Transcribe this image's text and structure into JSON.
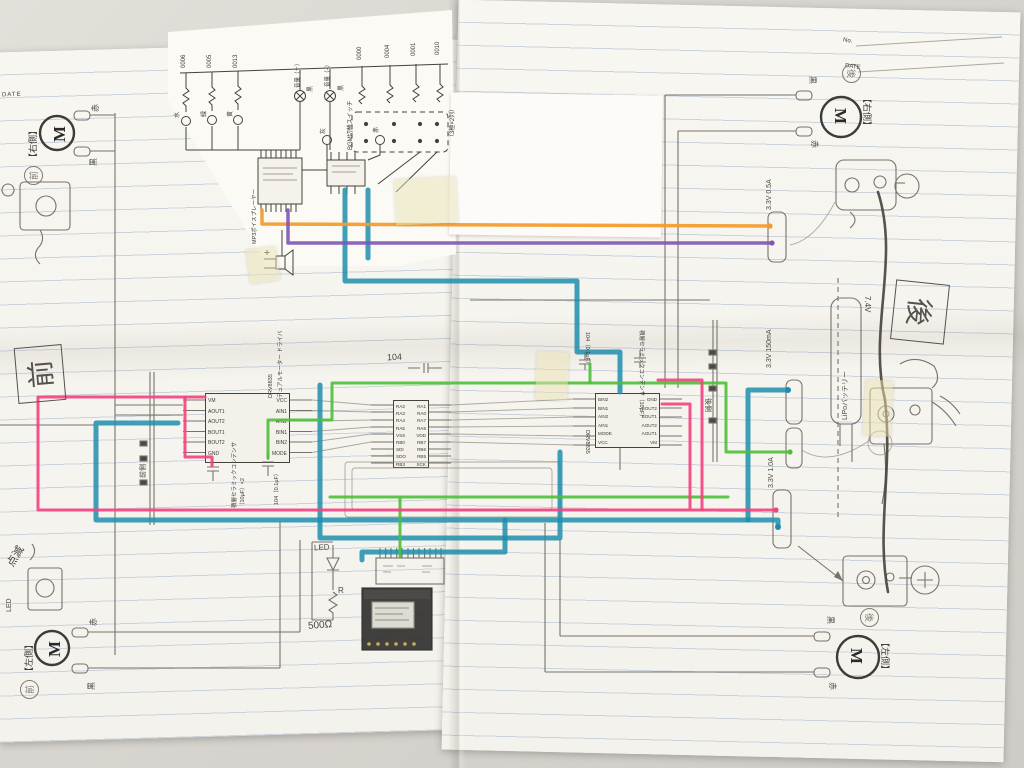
{
  "colors": {
    "wire_pink": "#f2427e",
    "wire_green": "#4fbf3a",
    "wire_teal": "#1d8dad",
    "wire_orange": "#f59a2a",
    "wire_purple": "#7e57b5",
    "pencil": "#6e675e",
    "paper": "#f8f6f0",
    "ruled_line": "#ccd2db",
    "background": "#d8d4cf"
  },
  "left_page": {
    "header_date": "DATE"
  },
  "right_page": {
    "header_no": "No.",
    "header_date": "DATE"
  },
  "overlay": {
    "resistor_ids": [
      "0006",
      "0005",
      "0013"
    ],
    "wire_color_labels": [
      "水",
      "緑",
      "黄"
    ],
    "volume_labels": [
      "音量（＋）",
      "音量（−）"
    ],
    "transistor_labels": [
      "黒",
      "黒",
      "灰",
      "赤"
    ],
    "switch_ids": [
      "0000",
      "0004",
      "0001",
      "0010"
    ],
    "switch_label": "BGM切替スイッチ",
    "switch_note": "（3極×2列）",
    "player_label": "MP3ボイスプレーヤー"
  },
  "motors": {
    "front_right": {
      "m": "M",
      "side": "【右側】",
      "stamp": "前",
      "red": "赤",
      "black": "黒"
    },
    "front_left": {
      "m": "M",
      "side": "【左側】",
      "stamp": "前",
      "red": "赤",
      "black": "黒"
    },
    "rear_right": {
      "m": "M",
      "side": "【右側】",
      "stamp": "後",
      "red": "赤",
      "black": "黒"
    },
    "rear_left": {
      "m": "M",
      "side": "【左側】",
      "stamp": "後",
      "red": "赤",
      "black": "黒"
    }
  },
  "driver_left": {
    "name": "DRV8835",
    "subtitle": "デュアルモーター ドライバ",
    "pins_left": [
      "VM",
      "AOUT1",
      "AOUT2",
      "BOUT1",
      "BOUT2",
      "GND"
    ],
    "pins_right": [
      "VCC",
      "AIN1",
      "AIN2",
      "BIN1",
      "BIN2",
      "MODE"
    ]
  },
  "driver_right": {
    "name": "DRV8835",
    "pins_left": [
      "BIN2",
      "BIN1",
      "AIN2",
      "AIN1",
      "MODE",
      "VCC"
    ],
    "pins_right": [
      "GND",
      "BOUT2",
      "BOUT1",
      "AOUT2",
      "AOUT1",
      "VM"
    ]
  },
  "mcu": {
    "pins_left": [
      "RA2",
      "RA3",
      "RA4",
      "RA5",
      "VSS",
      "RB0",
      "SDI",
      "SDO",
      "RB3"
    ],
    "pins_right": [
      "RA1",
      "RA0",
      "RA7",
      "RA6",
      "VDD",
      "RB7",
      "RB6",
      "RB5",
      "SCK"
    ],
    "cap_note": "104"
  },
  "capacitors": {
    "mlcc_label": "積層セラミックコンデンサ",
    "mlcc_value": "（10μF）×2",
    "mlcc_label_right": "積層セラミックコンデンサ（10μF）",
    "film_label": "104（0.1μF）"
  },
  "annotations": {
    "front_box": "前",
    "rear_box": "後",
    "front_side": "前側",
    "rear_side": "後側",
    "blink": "点滅",
    "led_note": "LED",
    "led": "LED",
    "r": "R",
    "resistor": "500Ω",
    "lipo": "LiPoバッテリー",
    "lipo_voltage": "7.4V",
    "power_top": "3.3V 0.5A",
    "power_mid": "3.3V 150mA",
    "power_bottom": "3.3V 1.0A"
  }
}
